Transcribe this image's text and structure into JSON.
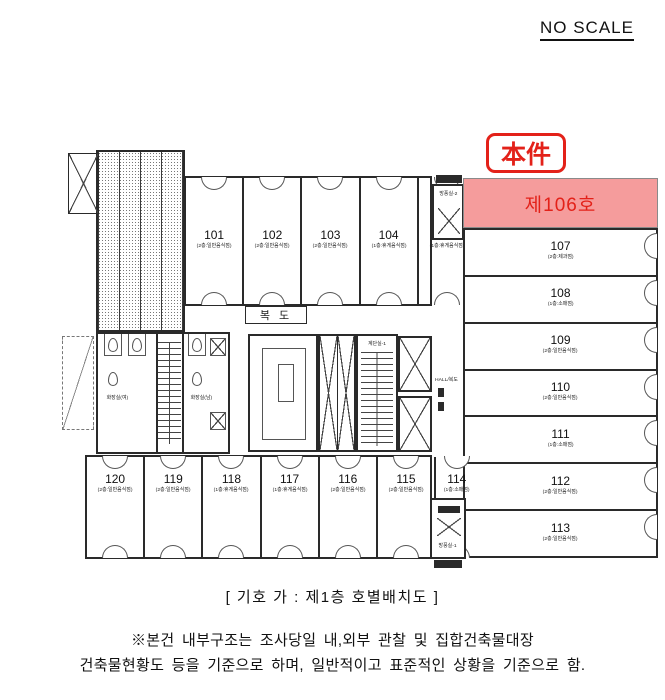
{
  "page": {
    "no_scale": "NO SCALE",
    "caption": "[  기호 가 : 제1층 호별배치도  ]",
    "footnote_line1": "※본건 내부구조는 조사당일 내,외부 관찰 및 집합건축물대장",
    "footnote_line2": "건축물현황도 등을 기준으로 하며, 일반적이고 표준적인 상황을 기준으로 함."
  },
  "highlight": {
    "badge": "本件",
    "unit_label": "제106호",
    "fill_color": "#f59c9c",
    "text_color": "#e32119"
  },
  "plan_labels": {
    "corridor": "복 도",
    "stair_room": "계단실-1",
    "hall": "HALL/복도",
    "vestibule_top": "방풍실-2",
    "vestibule_bottom": "방풍실-1",
    "toilet_women": "화장실(여)",
    "toilet_men": "화장실(남)"
  },
  "rooms_top": [
    {
      "number": "101",
      "use": "(2층:일반음식점)"
    },
    {
      "number": "102",
      "use": "(2층:일반음식점)"
    },
    {
      "number": "103",
      "use": "(2층:일반음식점)"
    },
    {
      "number": "104",
      "use": "(1층:휴게음식점)"
    },
    {
      "number": "105",
      "use": "(1층:휴게음식점)"
    }
  ],
  "rooms_right": [
    {
      "number": "107",
      "use": "(2층:제과점)"
    },
    {
      "number": "108",
      "use": "(1층:소매점)"
    },
    {
      "number": "109",
      "use": "(2층:일반음식점)"
    },
    {
      "number": "110",
      "use": "(2층:일반음식점)"
    },
    {
      "number": "111",
      "use": "(1층:소매점)"
    },
    {
      "number": "112",
      "use": "(2층:일반음식점)"
    },
    {
      "number": "113",
      "use": "(2층:일반음식점)"
    }
  ],
  "rooms_bottom": [
    {
      "number": "120",
      "use": "(2층:일반음식점)"
    },
    {
      "number": "119",
      "use": "(2층:일반음식점)"
    },
    {
      "number": "118",
      "use": "(1층:휴게음식점)"
    },
    {
      "number": "117",
      "use": "(1층:휴게음식점)"
    },
    {
      "number": "116",
      "use": "(2층:일반음식점)"
    },
    {
      "number": "115",
      "use": "(2층:일반음식점)"
    },
    {
      "number": "114",
      "use": "(1층:소매점)"
    }
  ]
}
